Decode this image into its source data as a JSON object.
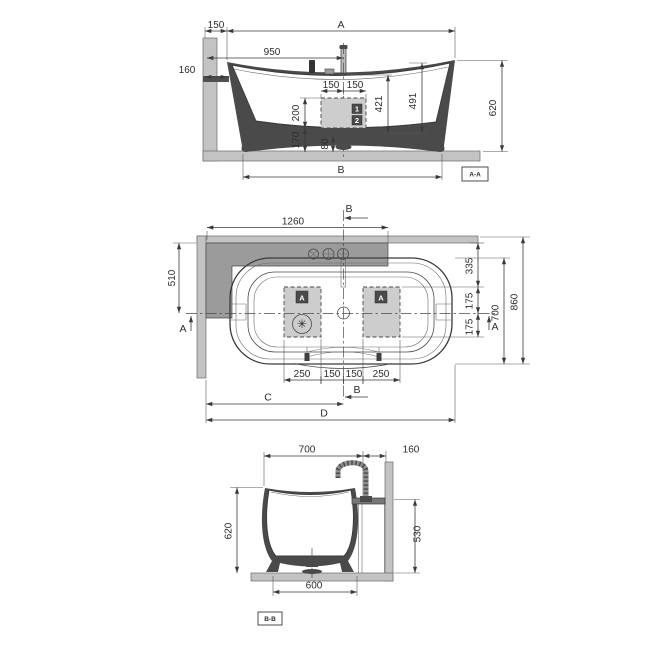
{
  "colors": {
    "line": "#3a3a3a",
    "wall_fill": "#c3c3c3",
    "deck_fill": "#9b9b9b",
    "panel_fill": "#cdcdcd",
    "marker_bg": "#4a4a4a",
    "marker_fg": "#ffffff"
  },
  "views": {
    "sideSection": {
      "tag": "A-A",
      "dims": {
        "w150": "150",
        "A": "A",
        "w950": "950",
        "w160": "160",
        "w150a": "150",
        "w150b": "150",
        "h200": "200",
        "h421": "421",
        "h491": "491",
        "h620": "620",
        "h170": "170",
        "h80": "80",
        "B": "B"
      },
      "markers": {
        "m1": "1",
        "m2": "2"
      }
    },
    "plan": {
      "dims": {
        "Btop": "B",
        "w1260": "1260",
        "h510": "510",
        "Aleft": "A",
        "h335": "335",
        "h175a": "175",
        "h175b": "175",
        "h700": "700",
        "h860": "860",
        "Aright": "A",
        "w250a": "250",
        "w150a": "150",
        "w150b": "150",
        "w250b": "250",
        "Bbottom": "B",
        "C": "C",
        "D": "D"
      },
      "markers": {
        "mAleft": "A",
        "mAright": "A",
        "asterisk": "✳"
      }
    },
    "endSection": {
      "tag": "B-B",
      "dims": {
        "w700": "700",
        "w160": "160",
        "h620": "620",
        "h530": "530",
        "w600": "600"
      }
    }
  }
}
